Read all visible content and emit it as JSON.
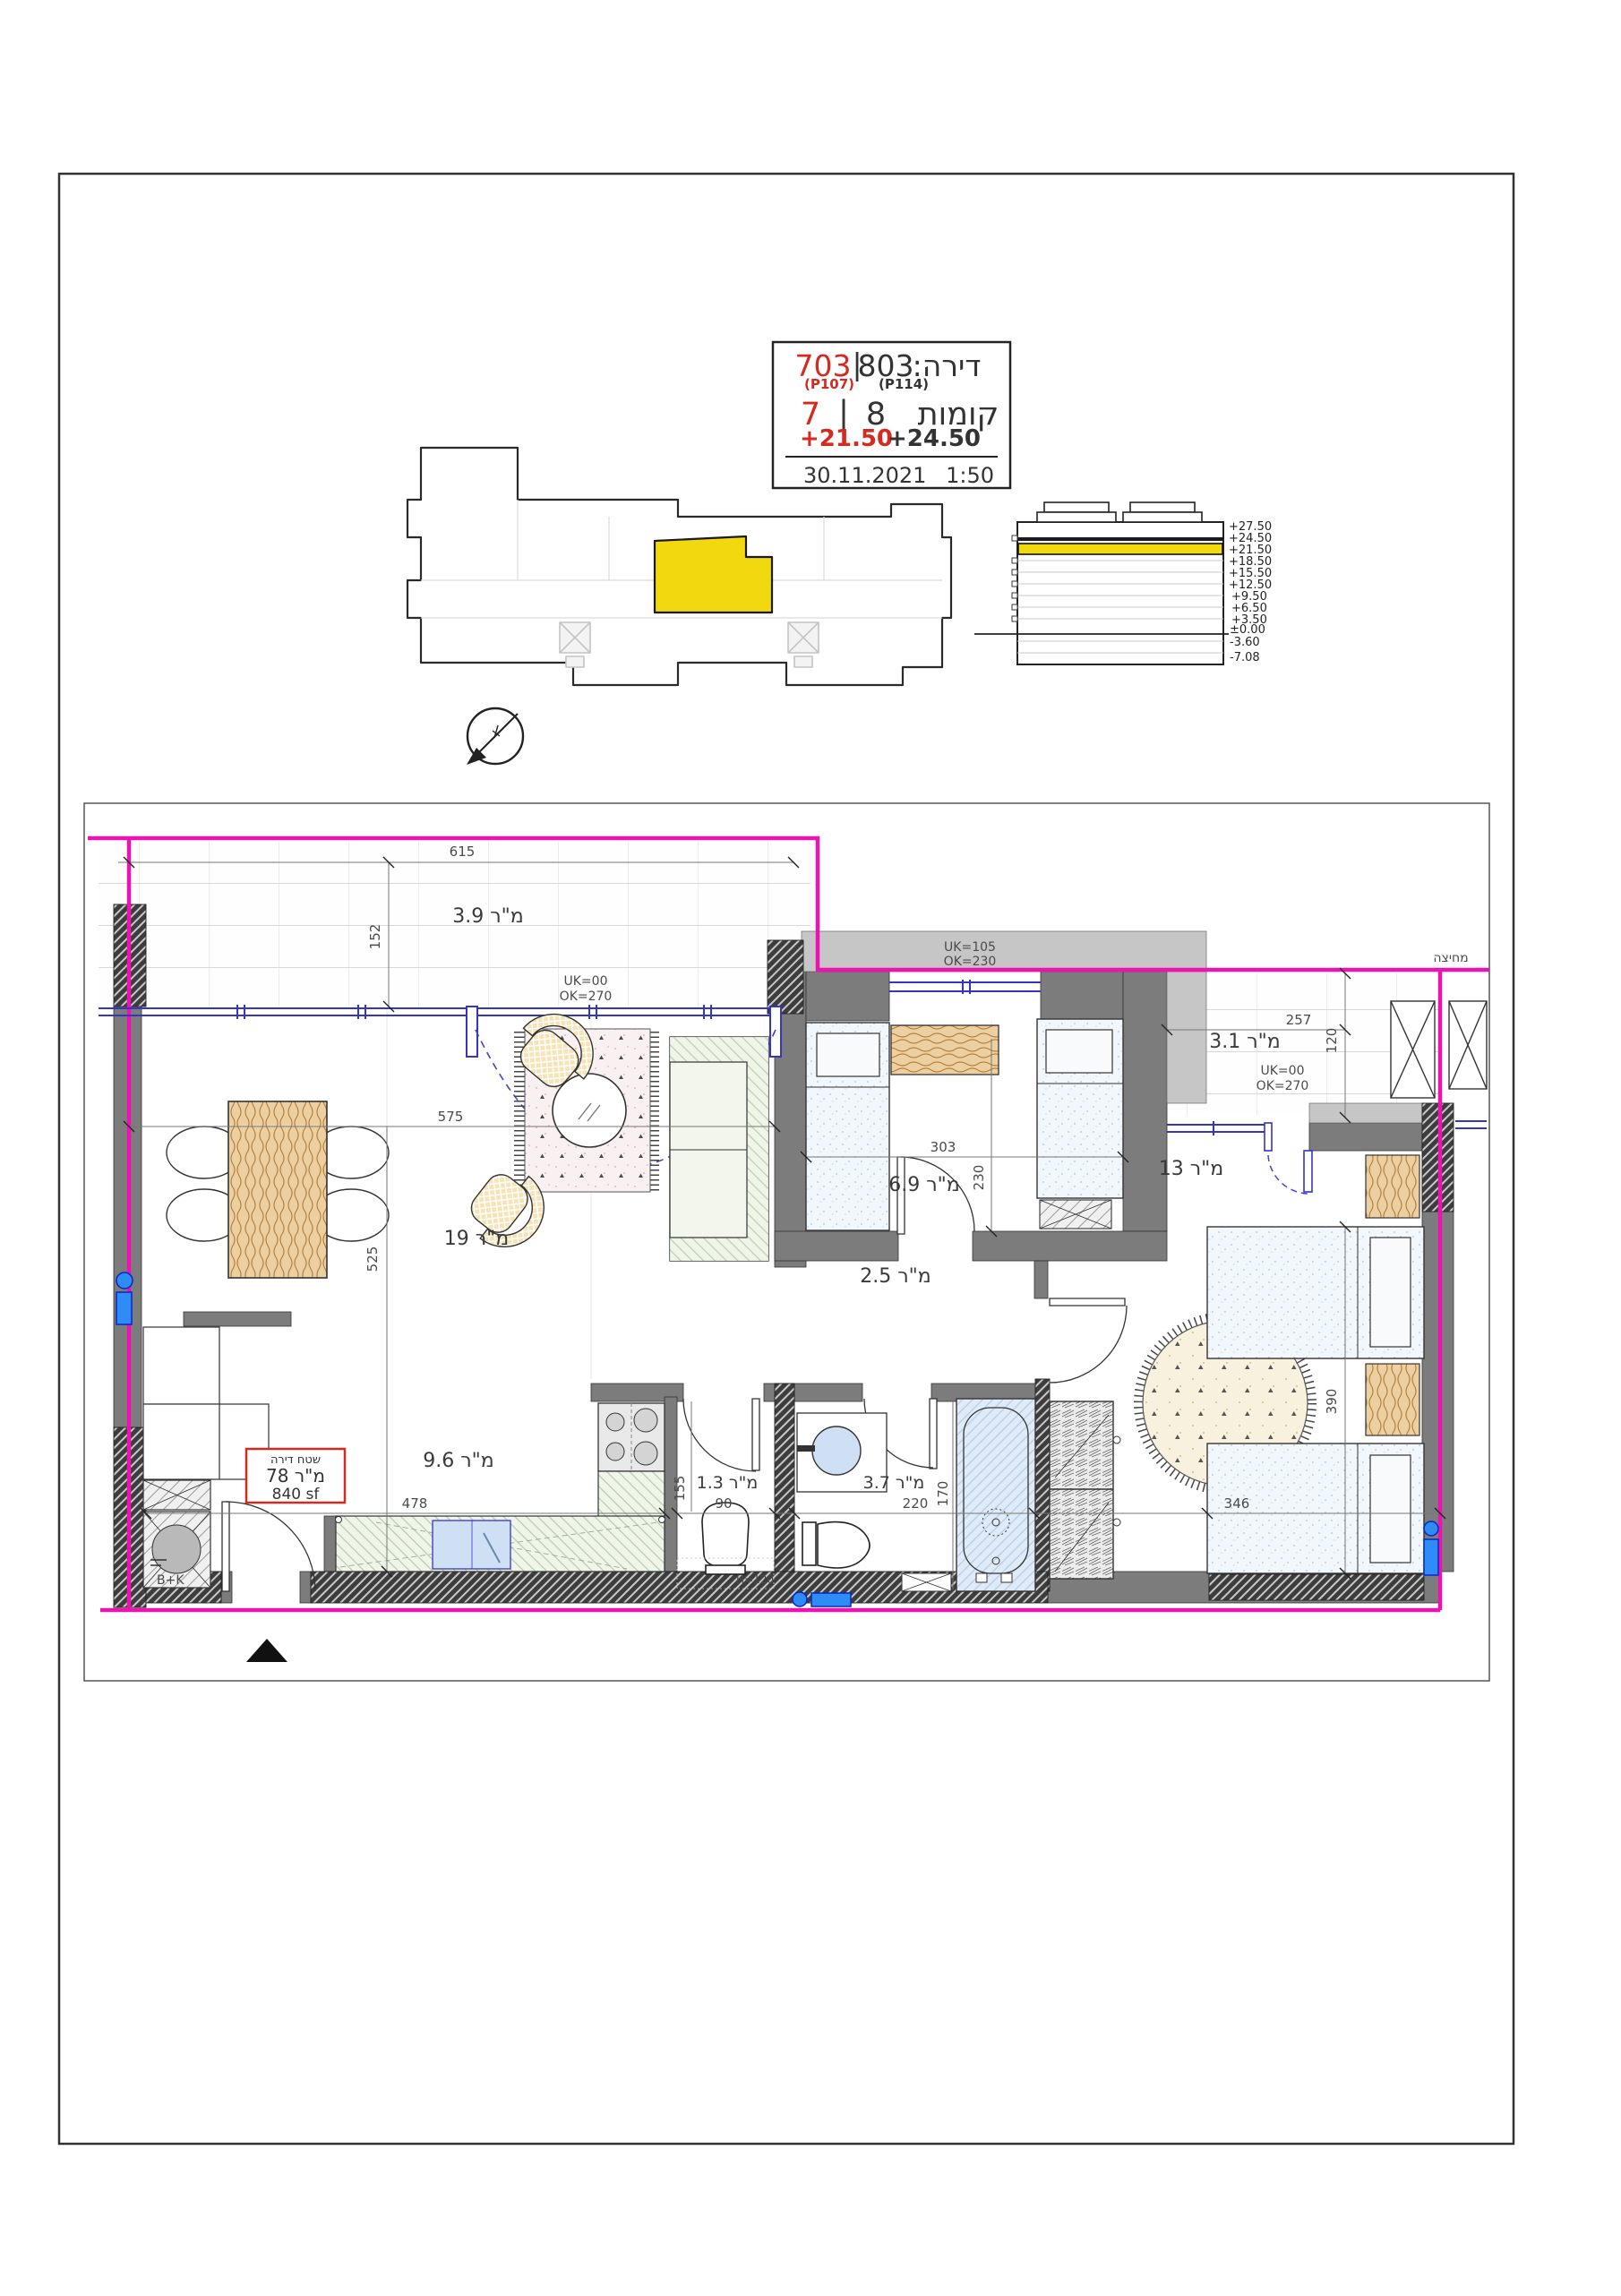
{
  "title_block": {
    "unit_label": "דירה:",
    "unit_secondary": "803",
    "unit_sep": "|",
    "unit_primary": "703",
    "p_secondary": "(P114)",
    "p_primary": "(P107)",
    "floors_label": "קומות",
    "floor_secondary": "8",
    "floor_sep": "|",
    "floor_primary": "7",
    "elev_primary": "+21.50",
    "elev_secondary": "+24.50",
    "date": "30.11.2021",
    "scale": "1:50"
  },
  "section": {
    "levels": [
      "+27.50",
      "+24.50",
      "+21.50",
      "+18.50",
      "+15.50",
      "+12.50",
      "+9.50",
      "+6.50",
      "+3.50",
      "±0.00",
      "-3.60",
      "-7.08"
    ]
  },
  "plan": {
    "rooms": {
      "balcony_living": "מ\"ר 3.9",
      "living": "מ\"ר 19",
      "bedroom": "מ\"ר 6.9",
      "balcony_master": "מ\"ר 3.1",
      "master": "מ\"ר 13",
      "hall": "מ\"ר 2.5",
      "kitchen": "מ\"ר 9.6",
      "wc": "מ\"ר 1.3",
      "bath": "מ\"ר 3.7"
    },
    "dims": {
      "d615": "615",
      "d152": "152",
      "d575": "575",
      "d525": "525",
      "d303": "303",
      "d230": "230",
      "d257": "257",
      "d120": "120",
      "d390": "390",
      "d346": "346",
      "d478": "478",
      "d90": "90",
      "d220": "220",
      "d170": "170",
      "d155": "155"
    },
    "notes": {
      "living_sill_a": "UK=00",
      "living_sill_b": "OK=270",
      "bed_sill_a": "UK=105",
      "bed_sill_b": "OK=230",
      "balc_sill_a": "UK=00",
      "balc_sill_b": "OK=270",
      "partition": "מחיצה",
      "shaft": "B+K",
      "wc_height": "H=120"
    },
    "area_box": {
      "title": "שטח דירה",
      "sqm": "מ\"ר 78",
      "sqf": "840 sf"
    }
  },
  "colors": {
    "accent_red": "#d42a20",
    "property_magenta": "#ee12b1",
    "highlight_yellow": "#f2d80e",
    "window_blue": "#3535c4"
  }
}
